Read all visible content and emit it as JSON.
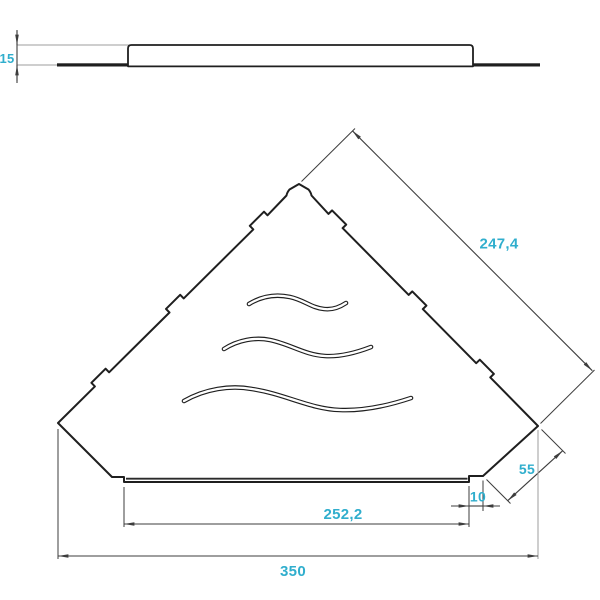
{
  "colors": {
    "background": "#ffffff",
    "accent_dimension_text": "#30aecd",
    "outline": "#1f1f1f",
    "dimension_lines": "#3d3d3d",
    "extension_lines_light": "#9e9e9e"
  },
  "views": {
    "side_view": {
      "dimensions": {
        "height": "15"
      }
    },
    "top_view": {
      "features": {
        "wave_slots_count": 3
      },
      "dimensions": {
        "edge_length": "247,4",
        "corner_chamfer": "55",
        "front_step": "10",
        "front_lip_width": "252,2",
        "overall_width": "350"
      }
    }
  }
}
